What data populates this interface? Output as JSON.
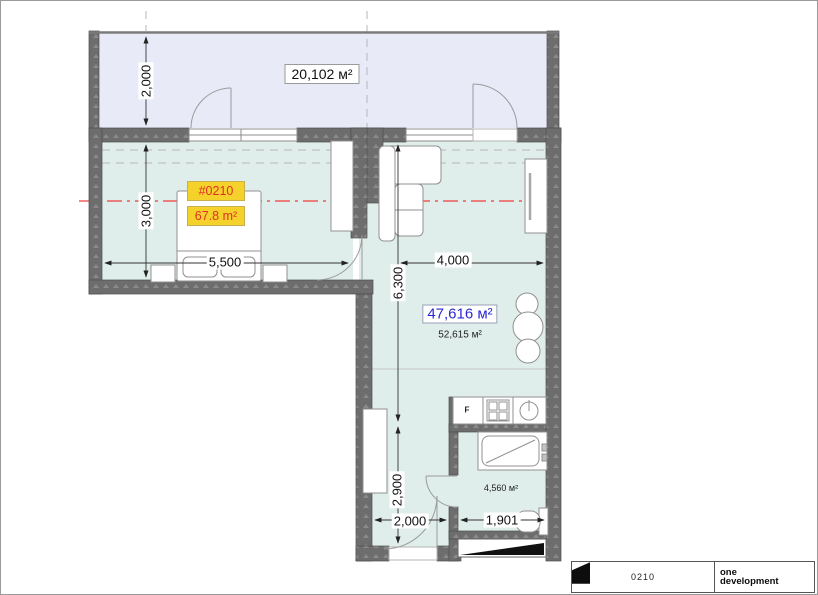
{
  "title_block": {
    "sheet_code": "0210",
    "brand_top": "one",
    "brand_bottom": "development"
  },
  "labels": {
    "balcony_area": "20,102 м²",
    "unit_number": "#0210",
    "unit_area": "67.8 m²",
    "living_area_primary": "47,616 м²",
    "living_area_secondary": "52,615 м²",
    "bathroom_area": "4,560 м²",
    "fridge": "F"
  },
  "dimensions": {
    "balcony_depth": "2,000",
    "bedroom_depth": "3,000",
    "bedroom_width": "5,500",
    "living_length": "6,300",
    "living_width": "4,000",
    "hall_length": "2,900",
    "hall_width": "2,000",
    "bathroom_width": "1,901"
  },
  "colors": {
    "wall": "#6d6d6d",
    "room_fill": "#dfeeea",
    "balcony_fill": "#e9eaf8",
    "accent_yellow": "#f5d22b",
    "accent_red": "#e03028",
    "accent_blue": "#2a2ad0",
    "centerline_red": "#f03c3c"
  }
}
